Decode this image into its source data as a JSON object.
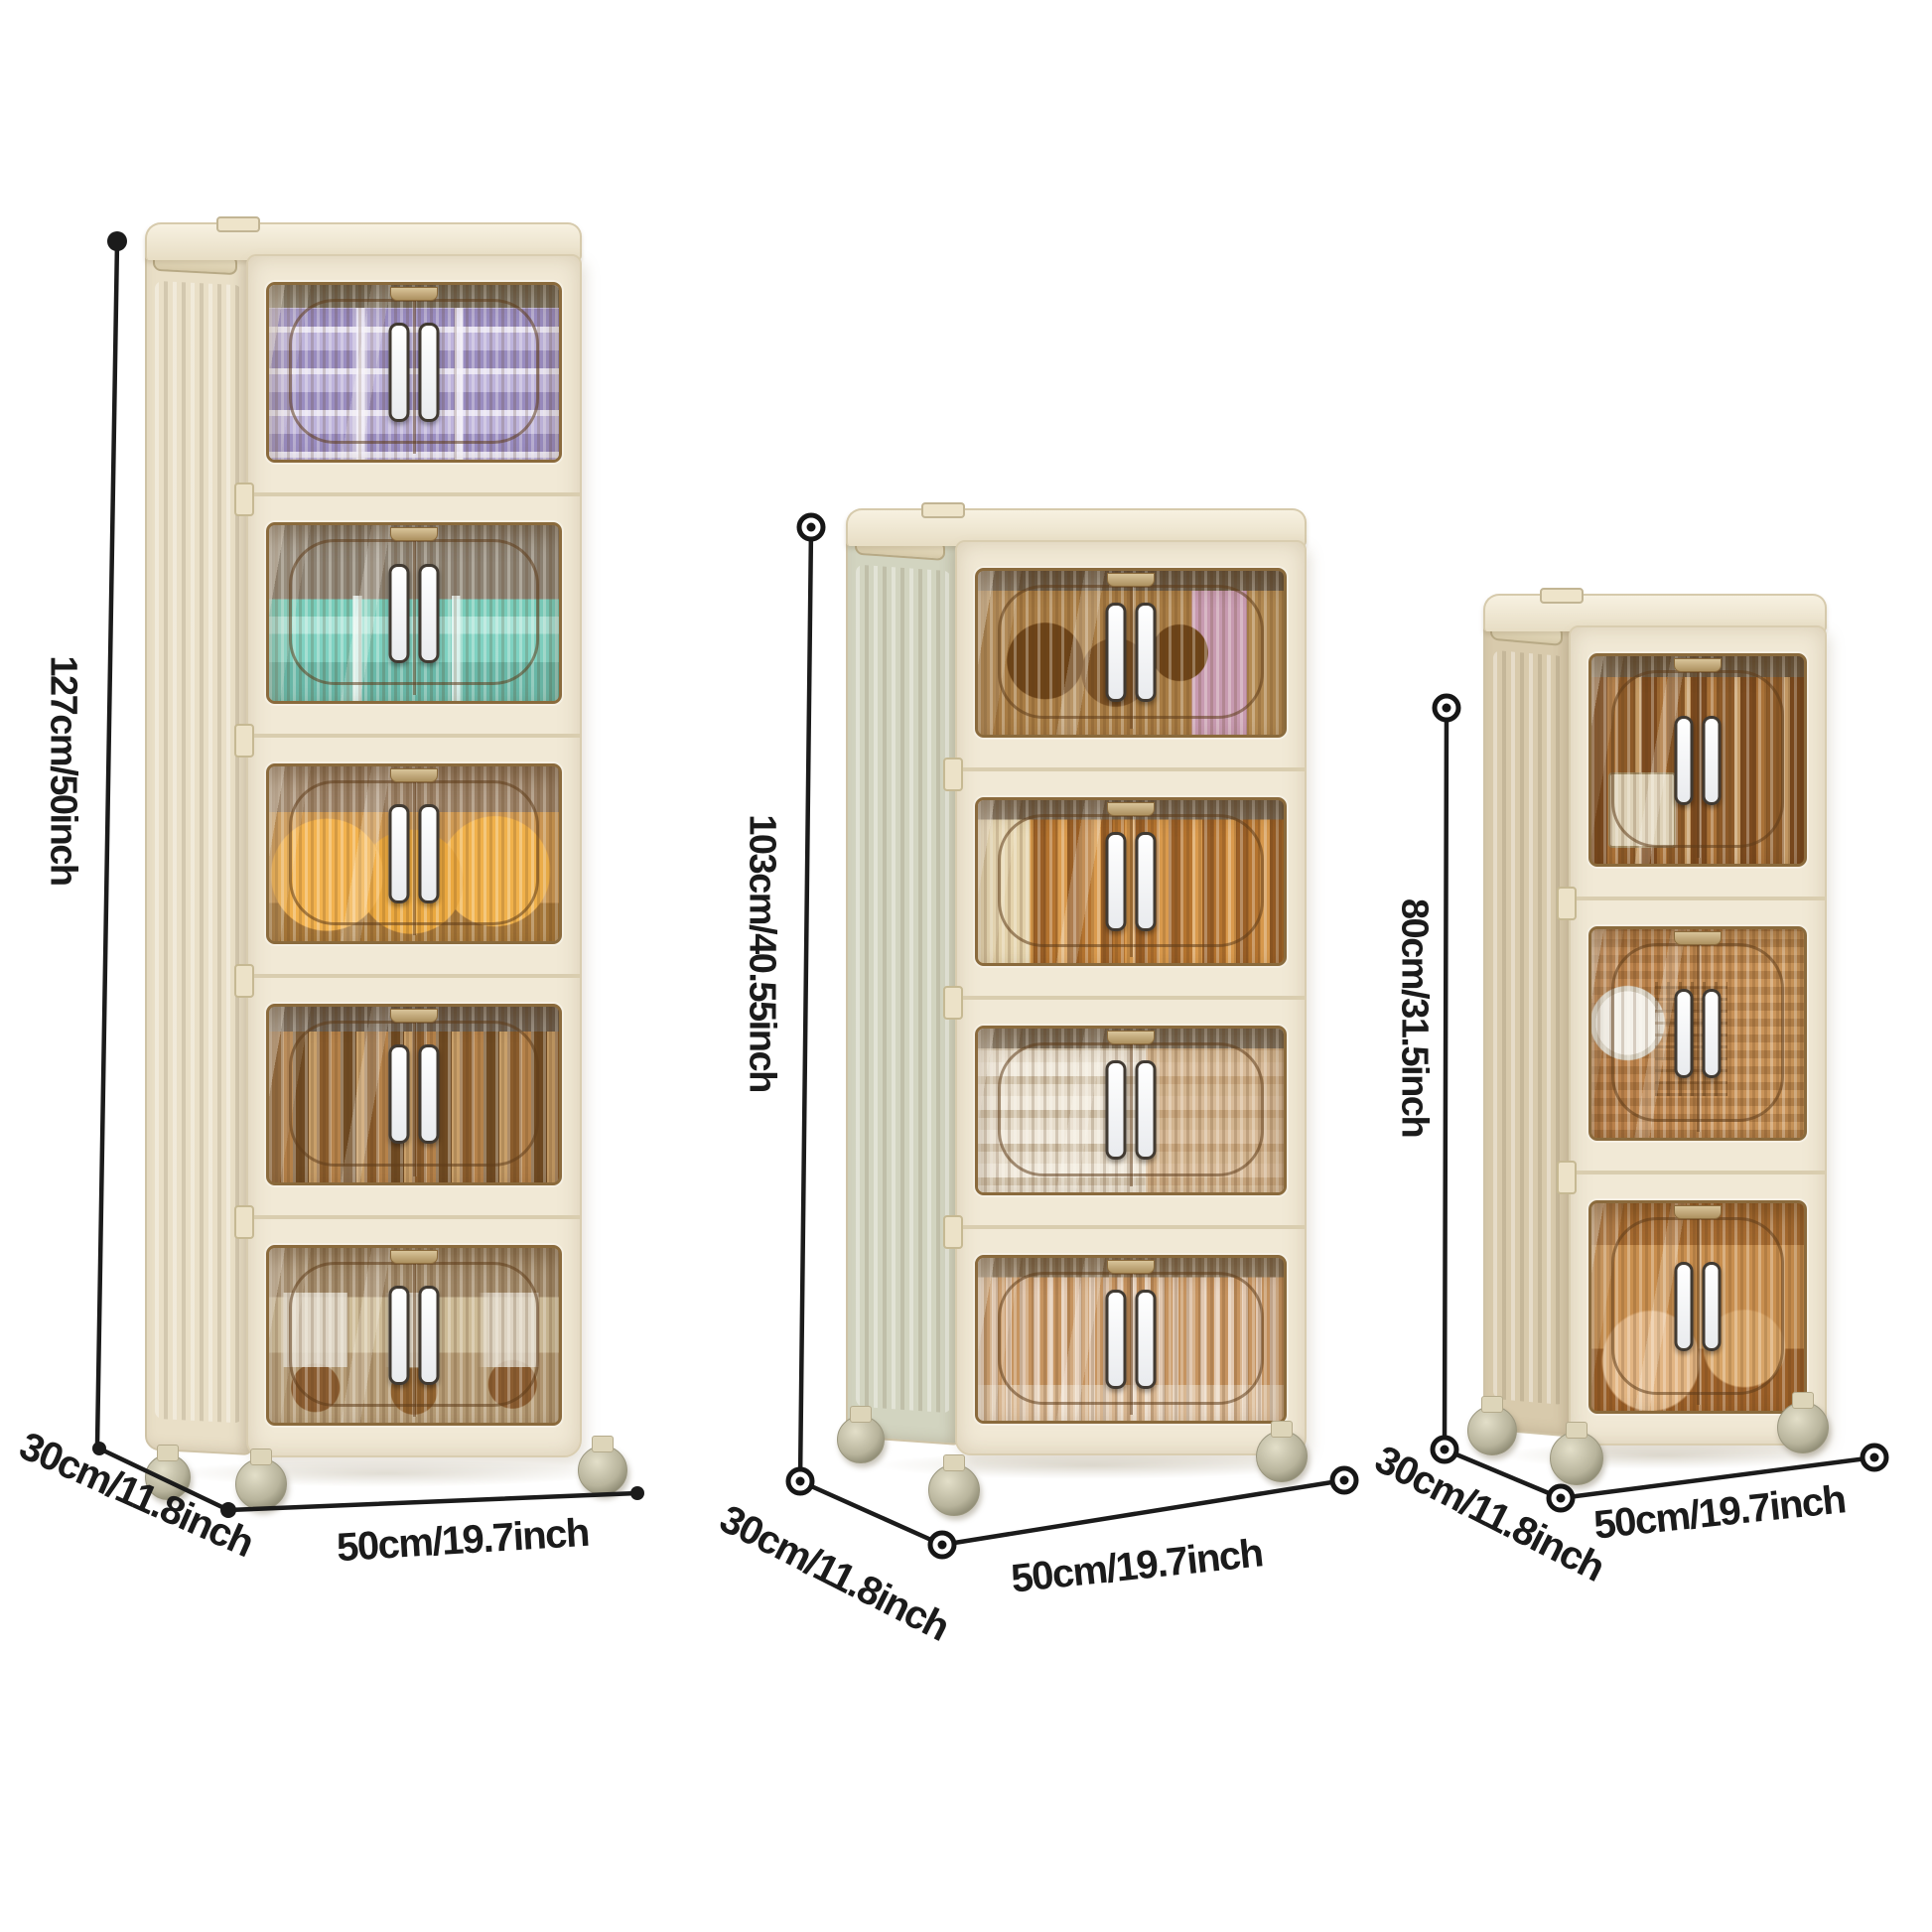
{
  "image_kind": "product-size-diagram",
  "colors": {
    "background": "#ffffff",
    "cabinet_body": "#f1e9d6",
    "door_tint_amber": "#b5803f",
    "handle": "#ffffff",
    "dimension_line": "#1b1b1b"
  },
  "cabinets": [
    {
      "id": "five-tier",
      "tier_count": 5,
      "height_label": "127cm/50inch",
      "depth_label": "30cm/11.8inch",
      "width_label": "50cm/19.7inch",
      "tier_contents": [
        "purple storage boxes",
        "teal containers",
        "orange snack packs",
        "books and magazines",
        "cat-print boxes"
      ]
    },
    {
      "id": "four-tier",
      "tier_count": 4,
      "height_label": "103cm/40.55inch",
      "depth_label": "30cm/11.8inch",
      "width_label": "50cm/19.7inch",
      "tier_contents": [
        "plush toys and pink box",
        "orange books",
        "folded linens",
        "cups and glassware"
      ]
    },
    {
      "id": "three-tier",
      "tier_count": 3,
      "height_label": "80cm/31.5inch",
      "depth_label": "30cm/11.8inch",
      "width_label": "50cm/19.7inch",
      "tier_contents": [
        "book spines and storage box",
        "plate and wire basket",
        "bowls"
      ]
    }
  ]
}
